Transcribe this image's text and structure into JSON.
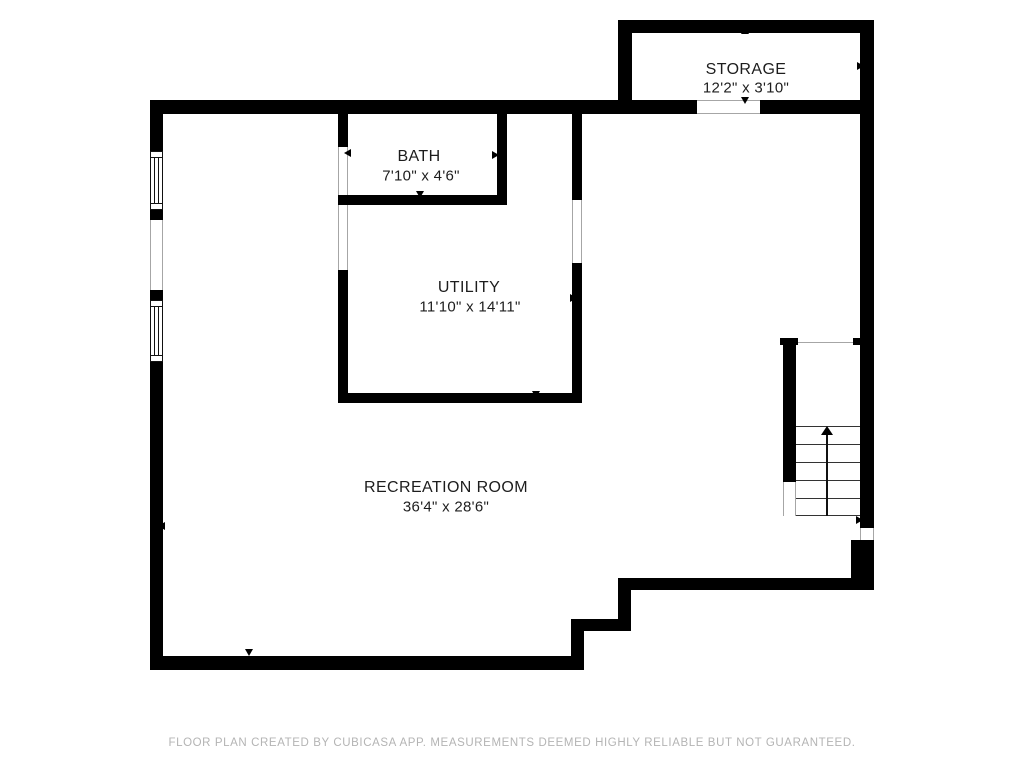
{
  "floorplan": {
    "rooms": [
      {
        "name": "STORAGE",
        "size": "12'2\" x 3'10\""
      },
      {
        "name": "BATH",
        "size": "7'10\" x 4'6\""
      },
      {
        "name": "UTILITY",
        "size": "11'10\" x 14'11\""
      },
      {
        "name": "RECREATION ROOM",
        "size": "36'4\" x 28'6\""
      }
    ],
    "stairs": {
      "direction": "up",
      "tread_count": 5
    },
    "window_count": 2,
    "colors": {
      "wall": "#000000",
      "room_text": "#1d1d1d",
      "footer_text": "#b4b4b4",
      "opening_outline": "#a6a6a6"
    }
  },
  "footer": {
    "text": "FLOOR PLAN CREATED BY CUBICASA APP. MEASUREMENTS DEEMED HIGHLY RELIABLE BUT NOT GUARANTEED."
  }
}
